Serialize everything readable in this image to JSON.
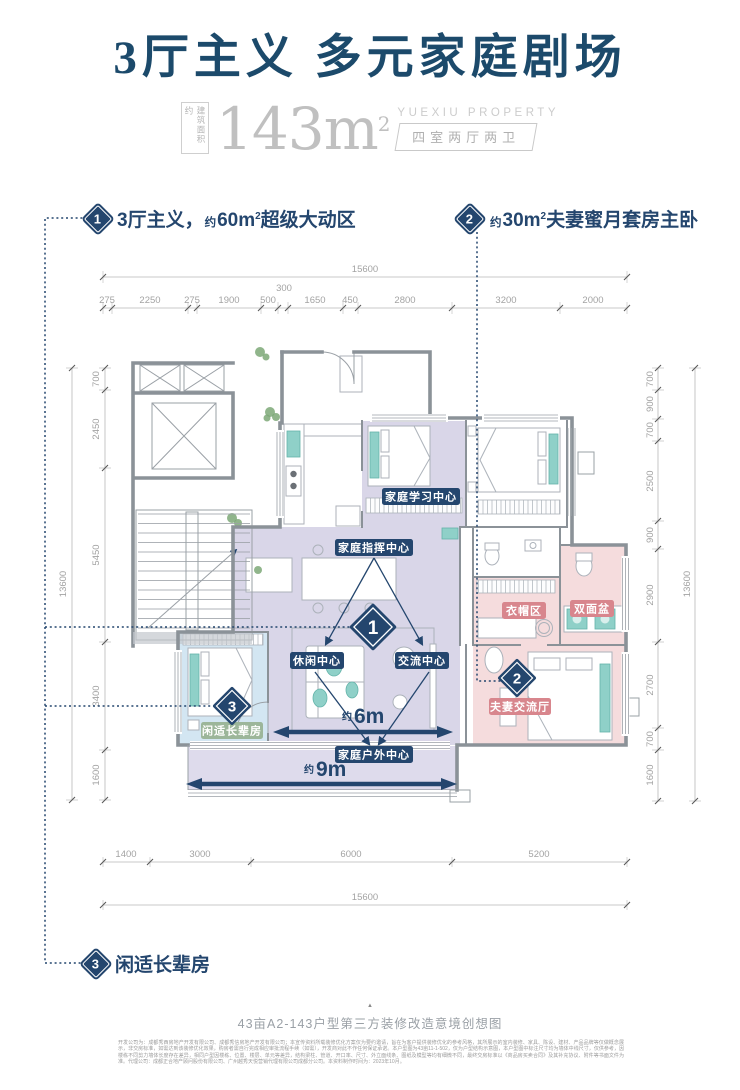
{
  "title": "3厅主义 多元家庭剧场",
  "subtitle": {
    "area_label_vertical": "建筑面积约",
    "area_value": "143m",
    "area_sup": "2",
    "brand": "YUEXIU PROPERTY",
    "layout_spec": "四室两厅两卫"
  },
  "callouts": {
    "c1": {
      "num": "1",
      "lead": "3厅主义，",
      "approx": "约",
      "value": "60m",
      "sup": "2",
      "tail": "超级大动区"
    },
    "c2": {
      "num": "2",
      "approx": "约",
      "value": "30m",
      "sup": "2",
      "tail": "夫妻蜜月套房主卧"
    },
    "c3": {
      "num": "3",
      "label": "闲适长辈房"
    }
  },
  "plan": {
    "zones": {
      "study": "家庭学习中心",
      "command": "家庭指挥中心",
      "leisure": "休闲中心",
      "exchange": "交流中心",
      "outdoor": "家庭户外中心",
      "cloak": "衣帽区",
      "basin": "双面盆",
      "couple": "夫妻交流厅",
      "elder": "闲适长辈房"
    },
    "markers": {
      "m1": "1",
      "m2": "2",
      "m3": "3"
    },
    "spans": {
      "w6_approx": "约",
      "w6": "6m",
      "w9_approx": "约",
      "w9": "9m"
    }
  },
  "dims": {
    "top_total": "15600",
    "top_segments": [
      "275",
      "2250",
      "275",
      "1900",
      "500",
      "300",
      "1650",
      "450",
      "2800",
      "3200",
      "2000"
    ],
    "bottom_segments": [
      "1400",
      "3000",
      "6000",
      "5200"
    ],
    "bottom_total": "15600",
    "left_total": "13600",
    "left_segments": [
      "700",
      "2450",
      "5450",
      "3400",
      "1600"
    ],
    "right_total": "13600",
    "right_segments": [
      "700",
      "900",
      "700",
      "2500",
      "900",
      "2900",
      "2700",
      "700",
      "1600"
    ]
  },
  "caption": "43亩A2-143户型第三方装修改造意境创想图",
  "caption_marker": "▲",
  "disclaimer": "开发公司为：成都秀西房地产开发有限公司、成都秀信房地产开发有限公司；本宣传资料所载装修优化方案仅为要约邀请，旨在为客户提供装修优化的参考风格，其所展示的室内装修、家具、陈设、建材、产品品牌等仅做概念展示，非交房标准，如需达到该装修优化效果，购房者需自行完成相应审批流程手续（如需），开发商对此不作任何保证承诺。本户型图为43亩11-1-502，仅为户型结构示意图，本户型图中标注尺寸均为墙体中线尺寸，仅供参考，因楼栋不同剪力墙体长度存在差异，相同户型因楼栋、位置、楼层、单元等差异，结构梁柱、管道、开口率、尺寸、外立面线条、图纸及模型等均有细微不同，最终交房标准以《商品房买卖合同》及其补充协议、附件等书面文件为准。代理公司：成都正合地产顾问股份有限公司、广州越秀天悦营销代理有限公司成都分公司。本资料制作时间为：2023年10月。",
  "colors": {
    "navy": "#24466e",
    "title_navy": "#1c4a6b",
    "living_purple": "#d9d6e8",
    "elder_blue": "#d3e6f2",
    "suite_pink": "#f5dcdd",
    "pink_badge": "#d8868d",
    "green_badge": "#9cb69a",
    "teal_accent": "#8fd0c8",
    "dim_gray": "#a3a3a3"
  }
}
